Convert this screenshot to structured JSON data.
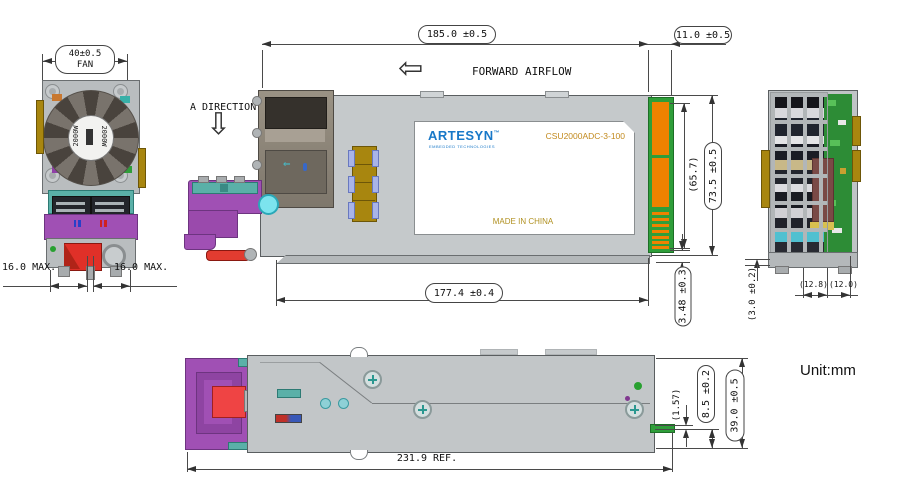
{
  "meta": {
    "unit_label": "Unit:mm"
  },
  "front_view": {
    "fan_dim": "40±0.5",
    "fan_dim_sub": "FAN",
    "fan_power_left": "2000W",
    "fan_power_right": "2000W",
    "max_left": "16.0 MAX.",
    "max_right": "16.0 MAX."
  },
  "side_view": {
    "direction_label": "A DIRECTION",
    "airflow_label": "FORWARD AIRFLOW",
    "dim_length": "185.0 ±0.5",
    "dim_card_edge": "11.0 ±0.5",
    "dim_pad_height": "(65.7)",
    "dim_height": "73.5 ±0.5",
    "dim_chassis_length": "177.4 ±0.4",
    "dim_bottom_offset": "3.48 ±0.3",
    "nameplate": {
      "brand": "ARTESYN",
      "trademark": "™",
      "tagline": "EMBEDDED TECHNOLOGIES",
      "model": "CSU2000ADC-3-100",
      "origin": "MADE IN CHINA"
    }
  },
  "rear_view": {
    "dim_gap": "(3.0 ±0.2)",
    "dim_left": "(12.8)",
    "dim_right": "(12.0)"
  },
  "bottom_view": {
    "dim_total": "231.9 REF.",
    "dim_pcb_offset": "(1.57)",
    "dim_edge": "8.5 ±0.2",
    "dim_width": "39.0 ±0.5"
  },
  "colors": {
    "handle_purple": "#a050b4",
    "latch_teal": "#5ab0a8",
    "lever_red": "#e23c30",
    "capacitor_gold": "#a8860f",
    "pcb_green": "#2f9e3a",
    "pad_orange": "#ef8200",
    "brand_blue": "#1878c8",
    "chassis_gray": "#c5c9cb",
    "model_gold": "#c28a1e"
  }
}
